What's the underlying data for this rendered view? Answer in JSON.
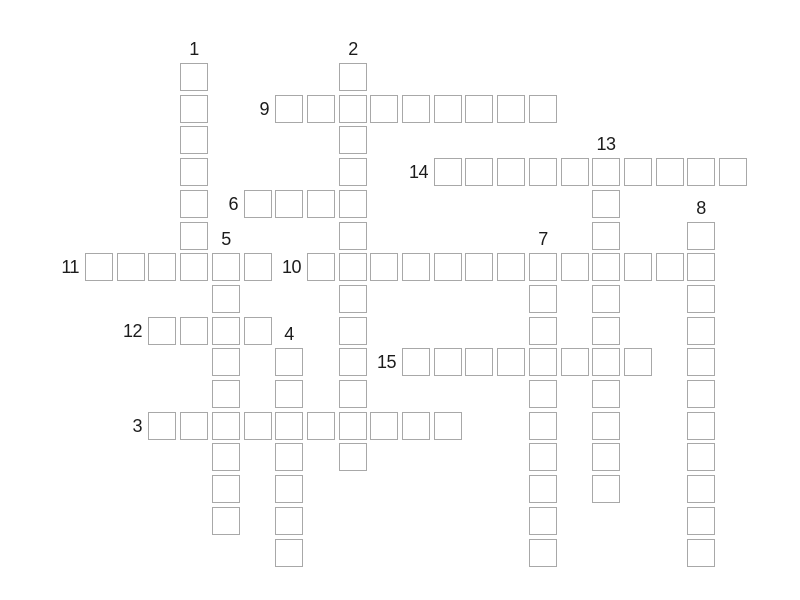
{
  "page": {
    "background": "#ffffff"
  },
  "puzzle": {
    "type": "crossword-grid",
    "colors": {
      "cell_fill": "#ffffff",
      "cell_border": "#a8a8a8",
      "number_color": "#1c1c1c",
      "background": "#ffffff"
    },
    "words": [
      {
        "number": "1",
        "direction": "down",
        "col": 3,
        "row": 0,
        "length": 7,
        "label_pos": "above"
      },
      {
        "number": "2",
        "direction": "down",
        "col": 8,
        "row": 0,
        "length": 13,
        "label_pos": "above"
      },
      {
        "number": "3",
        "direction": "across",
        "col": 2,
        "row": 11,
        "length": 10,
        "label_pos": "left"
      },
      {
        "number": "4",
        "direction": "down",
        "col": 6,
        "row": 9,
        "length": 7,
        "label_pos": "above"
      },
      {
        "number": "5",
        "direction": "down",
        "col": 4,
        "row": 6,
        "length": 9,
        "label_pos": "above"
      },
      {
        "number": "6",
        "direction": "across",
        "col": 5,
        "row": 4,
        "length": 4,
        "label_pos": "left"
      },
      {
        "number": "7",
        "direction": "down",
        "col": 14,
        "row": 6,
        "length": 10,
        "label_pos": "above"
      },
      {
        "number": "8",
        "direction": "down",
        "col": 19,
        "row": 5,
        "length": 11,
        "label_pos": "above"
      },
      {
        "number": "9",
        "direction": "across",
        "col": 6,
        "row": 1,
        "length": 9,
        "label_pos": "left"
      },
      {
        "number": "10",
        "direction": "across",
        "col": 7,
        "row": 6,
        "length": 13,
        "label_pos": "left"
      },
      {
        "number": "11",
        "direction": "across",
        "col": 0,
        "row": 6,
        "length": 6,
        "label_pos": "left"
      },
      {
        "number": "12",
        "direction": "across",
        "col": 2,
        "row": 8,
        "length": 4,
        "label_pos": "left"
      },
      {
        "number": "13",
        "direction": "down",
        "col": 16,
        "row": 3,
        "length": 11,
        "label_pos": "above"
      },
      {
        "number": "14",
        "direction": "across",
        "col": 11,
        "row": 3,
        "length": 10,
        "label_pos": "left"
      },
      {
        "number": "15",
        "direction": "across",
        "col": 10,
        "row": 9,
        "length": 8,
        "label_pos": "left"
      }
    ]
  }
}
